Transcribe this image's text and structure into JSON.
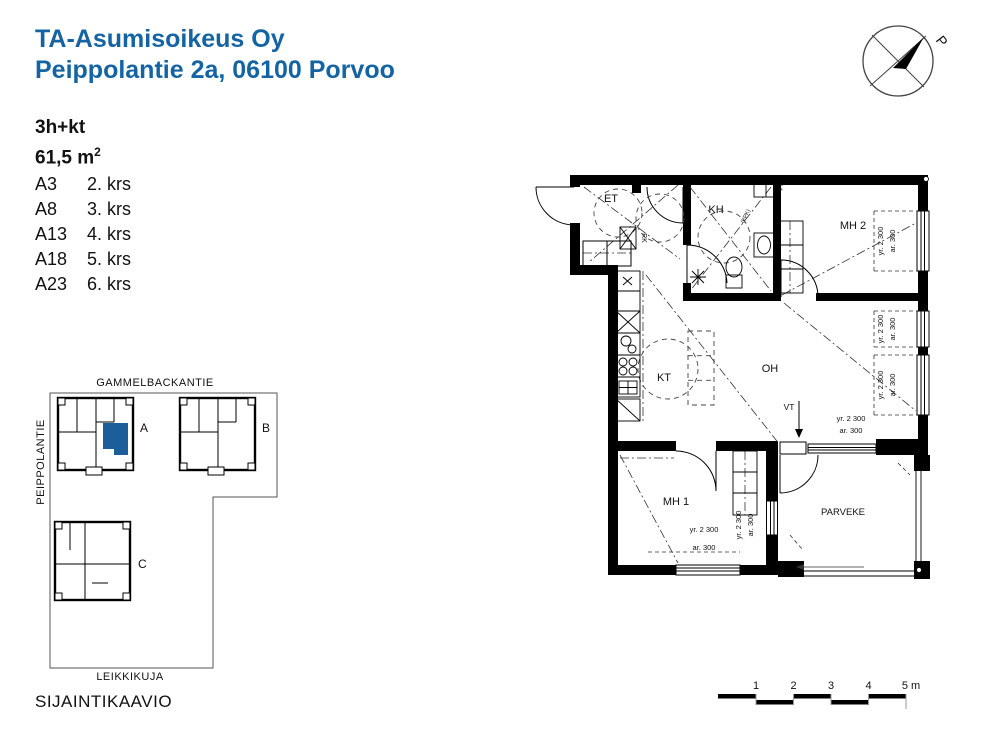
{
  "header": {
    "title_line1": "TA-Asumisoikeus Oy",
    "title_line2": "Peippolantie 2a, 06100 Porvoo"
  },
  "apartment": {
    "type": "3h+kt",
    "area": "61,5 m",
    "area_sup": "2",
    "units": [
      {
        "id": "A3",
        "floor": "2. krs"
      },
      {
        "id": "A8",
        "floor": "3. krs"
      },
      {
        "id": "A13",
        "floor": "4. krs"
      },
      {
        "id": "A18",
        "floor": "5. krs"
      },
      {
        "id": "A23",
        "floor": "6. krs"
      }
    ]
  },
  "site": {
    "street_top": "GAMMELBACKANTIE",
    "street_left": "PEIPPOLANTIE",
    "street_bottom": "LEIKKIKUJA",
    "building_a": "A",
    "building_b": "B",
    "building_c": "C",
    "caption": "SIJAINTIKAAVIO"
  },
  "plan": {
    "rooms": {
      "et": "ET",
      "kh": "KH",
      "mh2": "MH 2",
      "kt": "KT",
      "oh": "OH",
      "mh1": "MH 1",
      "parveke": "PARVEKE"
    },
    "labels": {
      "rk": "RK",
      "vt": "VT",
      "py": "PY",
      "ppk": "(PPK)"
    },
    "dim_yr": "yr. 2 300",
    "dim_ar": "ar. 300"
  },
  "compass": {
    "north_label": "P"
  },
  "scalebar": {
    "labels": [
      "1",
      "2",
      "3",
      "4",
      "5 m"
    ]
  },
  "colors": {
    "title_blue": "#1464a4",
    "apartment_highlight": "#1c5e99"
  }
}
